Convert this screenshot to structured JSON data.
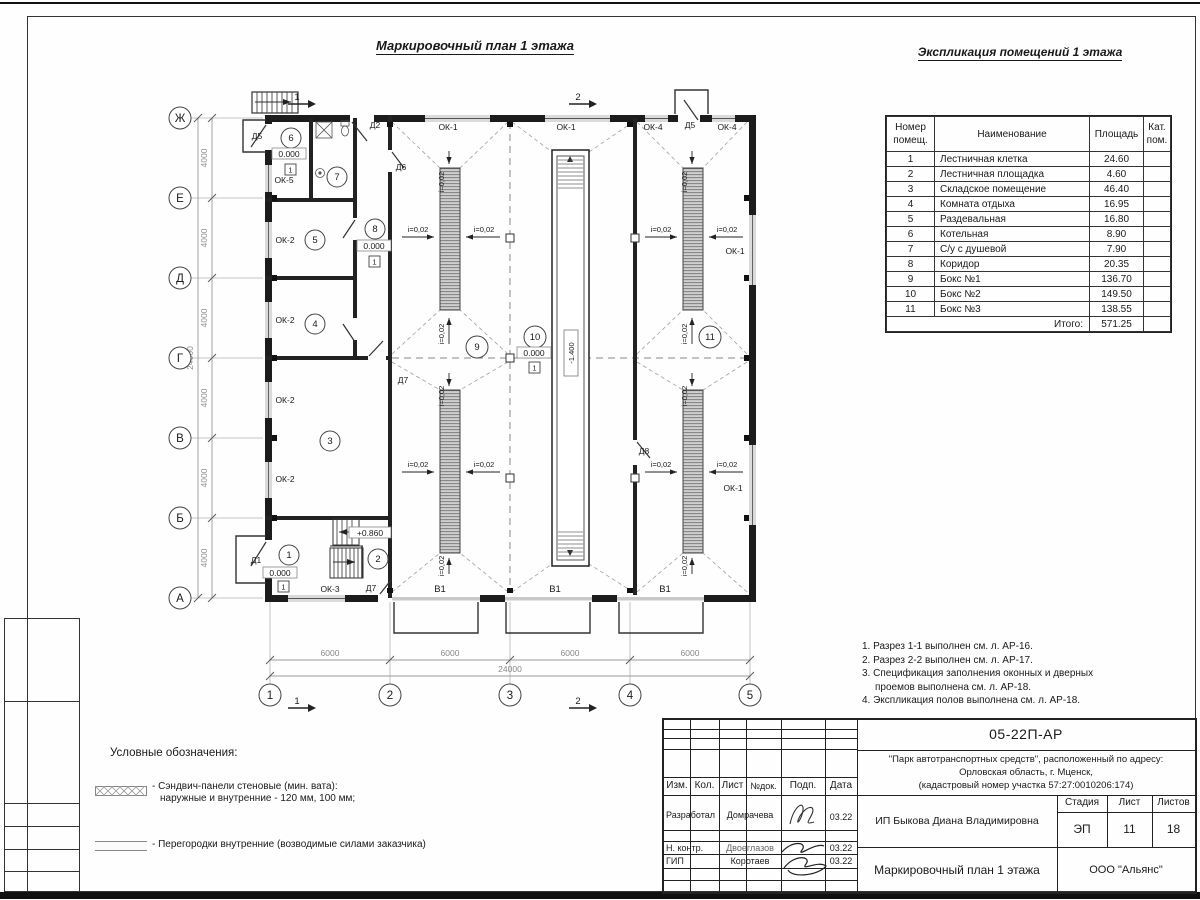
{
  "page": {
    "plan_title": "Маркировочный план 1 этажа",
    "table_title": "Экспликация помещений 1 этажа"
  },
  "exp_table": {
    "h_num": "Номер\nпомещ.",
    "h_name": "Наименование",
    "h_area": "Площадь",
    "h_cat": "Кат.\nпом.",
    "rows": [
      {
        "n": "1",
        "name": "Лестничная клетка",
        "a": "24.60"
      },
      {
        "n": "2",
        "name": "Лестничная площадка",
        "a": "4.60"
      },
      {
        "n": "3",
        "name": "Складское помещение",
        "a": "46.40"
      },
      {
        "n": "4",
        "name": "Комната отдыха",
        "a": "16.95"
      },
      {
        "n": "5",
        "name": "Раздевальная",
        "a": "16.80"
      },
      {
        "n": "6",
        "name": "Котельная",
        "a": "8.90"
      },
      {
        "n": "7",
        "name": "С/у с душевой",
        "a": "7.90"
      },
      {
        "n": "8",
        "name": "Коридор",
        "a": "20.35"
      },
      {
        "n": "9",
        "name": "Бокс №1",
        "a": "136.70"
      },
      {
        "n": "10",
        "name": "Бокс №2",
        "a": "149.50"
      },
      {
        "n": "11",
        "name": "Бокс №3",
        "a": "138.55"
      }
    ],
    "total_label": "Итого:",
    "total_value": "571.25"
  },
  "notes": {
    "line1": "1. Разрез 1-1 выполнен см. л. АР-16.",
    "line2": "2. Разрез 2-2 выполнен см. л. АР-17.",
    "line3": "3. Спецификация заполнения оконных и дверных",
    "line3b": "проемов выполнена см. л. АР-18.",
    "line4": "4. Экспликация полов выполнена см. л. АР-18."
  },
  "legend": {
    "title": "Условные обозначения:",
    "item1_line1": "- Сэндвич-панели стеновые (мин. вата):",
    "item1_line2": "наружные и внутренние - 120 мм, 100 мм;",
    "item2": "- Перегородки внутренние (возводимые силами заказчика)"
  },
  "titleblock": {
    "doc_number": "05-22П-АР",
    "project_line1": "\"Парк автотранспортных средств\",  расположенный по адресу:",
    "project_line2": "Орловская область, г. Мценск,",
    "project_line3": "(кадастровый номер участка 57:27:0010206:174)",
    "client": "ИП Быкова Диана Владимировна",
    "sheet_title": "Маркировочный план 1 этажа",
    "company": "ООО \"Альянс\"",
    "stage_label": "Стадия",
    "stage_value": "ЭП",
    "sheet_label": "Лист",
    "sheet_value": "11",
    "sheets_label": "Листов",
    "sheets_value": "18",
    "col_izm": "Изм.",
    "col_kol": "Кол.",
    "col_list": "Лист",
    "col_doc": "№док.",
    "col_sign": "Подп.",
    "col_date": "Дата",
    "role1": "Разработал",
    "name1": "Домрачева",
    "date1": "03.22",
    "role2": "Н. контр.",
    "name2": "Двоеглазов",
    "date2": "03.22",
    "role3": "ГИП",
    "name3": "Коротаев",
    "date3": "03.22"
  },
  "plan": {
    "grid_rows": [
      "Ж",
      "Е",
      "Д",
      "Г",
      "В",
      "Б",
      "А"
    ],
    "grid_cols": [
      "1",
      "2",
      "3",
      "4",
      "5"
    ],
    "dim_v": "4000",
    "dim_h": "6000",
    "dim_total": "24000",
    "rooms": [
      "1",
      "2",
      "3",
      "4",
      "5",
      "6",
      "7",
      "8",
      "9",
      "10",
      "11"
    ],
    "lvl_zero": "0.000",
    "lvl_plus": "+0.860",
    "lvl_minus": "-1.400",
    "floor_type": "1",
    "slope": "i=0,02",
    "ok1": "ОК-1",
    "ok2": "ОК-2",
    "ok3": "ОК-3",
    "ok4": "ОК-4",
    "ok5": "ОК-5",
    "d1": "Д1",
    "d2": "Д2",
    "d5": "Д5",
    "d6": "Д6",
    "d7": "Д7",
    "d8": "Д8",
    "v1": "В1",
    "sec1": "1",
    "sec2": "2"
  }
}
